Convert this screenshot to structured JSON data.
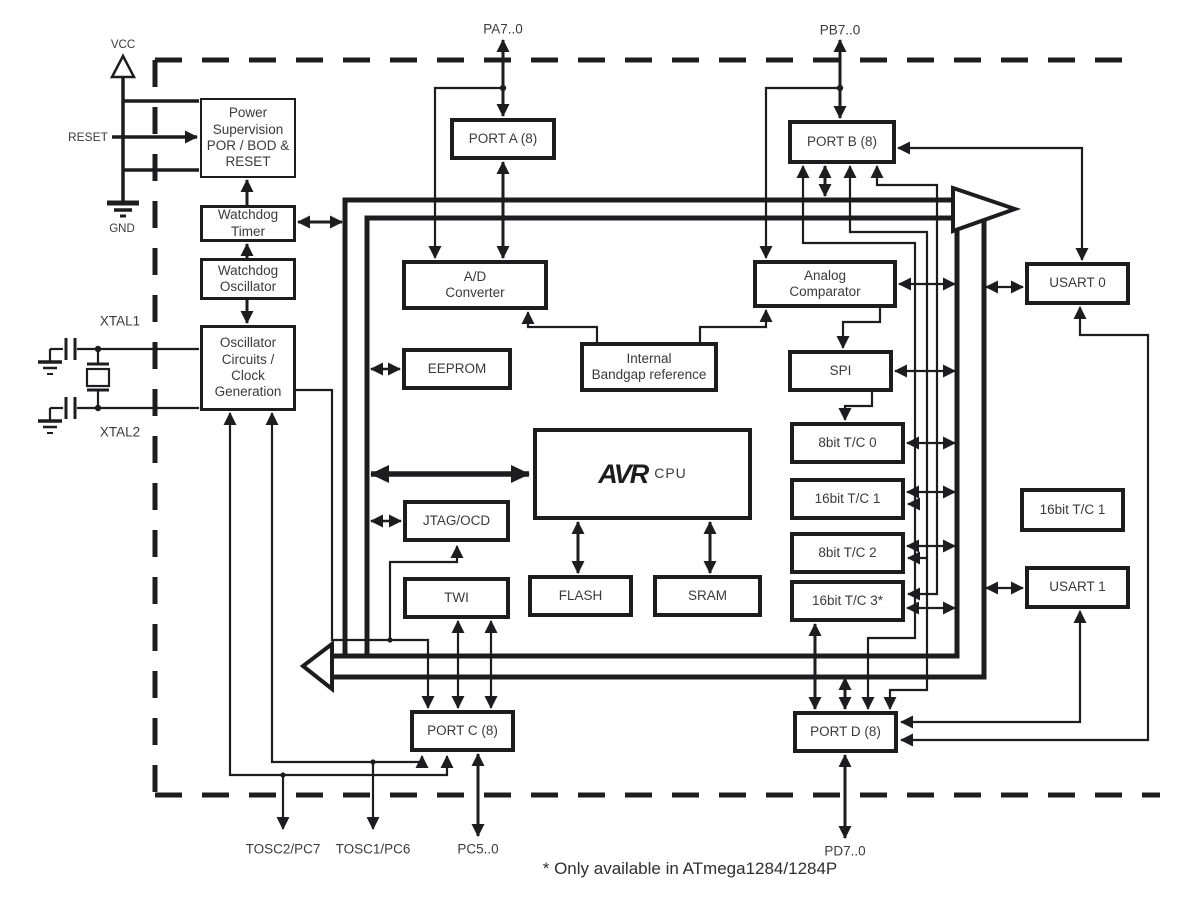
{
  "title": "AVR microcontroller block diagram",
  "footnote": "* Only available in ATmega1284/1284P",
  "colors": {
    "line": "#1d1d1f",
    "text": "#3a3a3c",
    "background": "#ffffff"
  },
  "blocks": {
    "power": {
      "label": "Power\nSupervision\nPOR / BOD &\nRESET"
    },
    "wdt": {
      "label": "Watchdog\nTimer"
    },
    "wdo": {
      "label": "Watchdog\nOscillator"
    },
    "osc": {
      "label": "Oscillator\nCircuits /\nClock\nGeneration"
    },
    "port_a": {
      "label": "PORT A (8)"
    },
    "adc": {
      "label": "A/D\nConverter"
    },
    "eeprom": {
      "label": "EEPROM"
    },
    "bandgap": {
      "label": "Internal\nBandgap reference"
    },
    "port_b": {
      "label": "PORT B (8)"
    },
    "comp": {
      "label": "Analog\nComparator"
    },
    "spi": {
      "label": "SPI"
    },
    "tc0": {
      "label": "8bit T/C 0"
    },
    "tc1": {
      "label": "16bit T/C 1"
    },
    "tc2": {
      "label": "8bit T/C 2"
    },
    "tc3": {
      "label": "16bit T/C 3*"
    },
    "cpu": {
      "logo": "AVR",
      "sub": "CPU"
    },
    "jtag": {
      "label": "JTAG/OCD"
    },
    "twi": {
      "label": "TWI"
    },
    "flash": {
      "label": "FLASH"
    },
    "sram": {
      "label": "SRAM"
    },
    "port_c": {
      "label": "PORT C (8)"
    },
    "port_d": {
      "label": "PORT D (8)"
    },
    "usart0": {
      "label": "USART 0"
    },
    "tc1b": {
      "label": "16bit T/C 1"
    },
    "usart1": {
      "label": "USART 1"
    }
  },
  "pins": {
    "vcc": "VCC",
    "reset": "RESET",
    "gnd": "GND",
    "xtal1": "XTAL1",
    "xtal2": "XTAL2",
    "pa": "PA7..0",
    "pb": "PB7..0",
    "tosc2": "TOSC2/PC7",
    "tosc1": "TOSC1/PC6",
    "pc": "PC5..0",
    "pd": "PD7..0"
  }
}
